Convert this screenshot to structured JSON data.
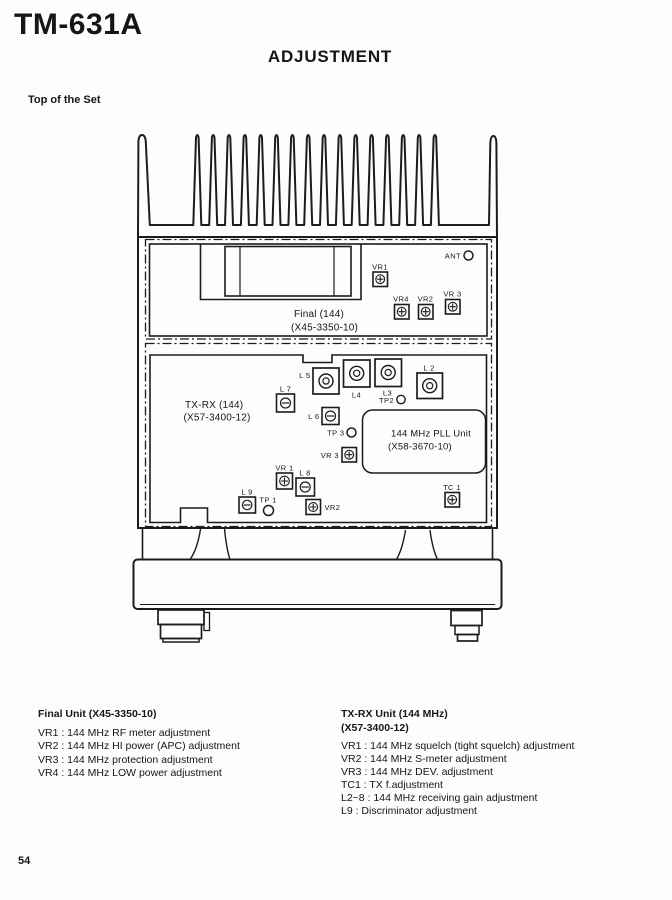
{
  "page": {
    "model": "TM-631A",
    "section_title": "ADJUSTMENT",
    "figure_title": "Top of the Set",
    "page_number": "54"
  },
  "diagram": {
    "ant_label": "ANT",
    "final_board": {
      "name": "Final (144)",
      "code": "(X45-3350-10)",
      "vr1": "VR1",
      "vr4": "VR4",
      "vr2": "VR2",
      "vr3": "VR 3"
    },
    "txrx_board": {
      "name": "TX-RX (144)",
      "code": "(X57-3400-12)",
      "l2": "L 2",
      "l3": "L3",
      "l4": "L4",
      "l5": "L 5",
      "l6": "L 6",
      "l7": "L 7",
      "l8": "L 8",
      "l9": "L 9",
      "tp1": "TP 1",
      "tp2": "TP2",
      "tp3": "TP 3",
      "vr1": "VR 1",
      "vr2": "VR2",
      "vr3": "VR 3",
      "tc1": "TC 1"
    },
    "pll_unit": {
      "name": "144 MHz PLL Unit",
      "code": "(X58-3670-10)"
    }
  },
  "legend": {
    "final_unit": {
      "title": "Final Unit (X45-3350-10)",
      "items": [
        "VR1 : 144 MHz RF meter adjustment",
        "VR2 : 144 MHz HI power (APC) adjustment",
        "VR3 : 144 MHz protection adjustment",
        "VR4 : 144 MHz LOW power adjustment"
      ]
    },
    "txrx_unit": {
      "title": "TX-RX Unit (144 MHz)",
      "code": "(X57-3400-12)",
      "items": [
        "VR1 : 144 MHz squelch (tight squelch) adjustment",
        "VR2 : 144 MHz S-meter adjustment",
        "VR3 : 144 MHz DEV. adjustment",
        "TC1 : TX f.adjustment",
        "L2~8 : 144 MHz receiving gain adjustment",
        "L9 : Discriminator adjustment"
      ]
    }
  }
}
